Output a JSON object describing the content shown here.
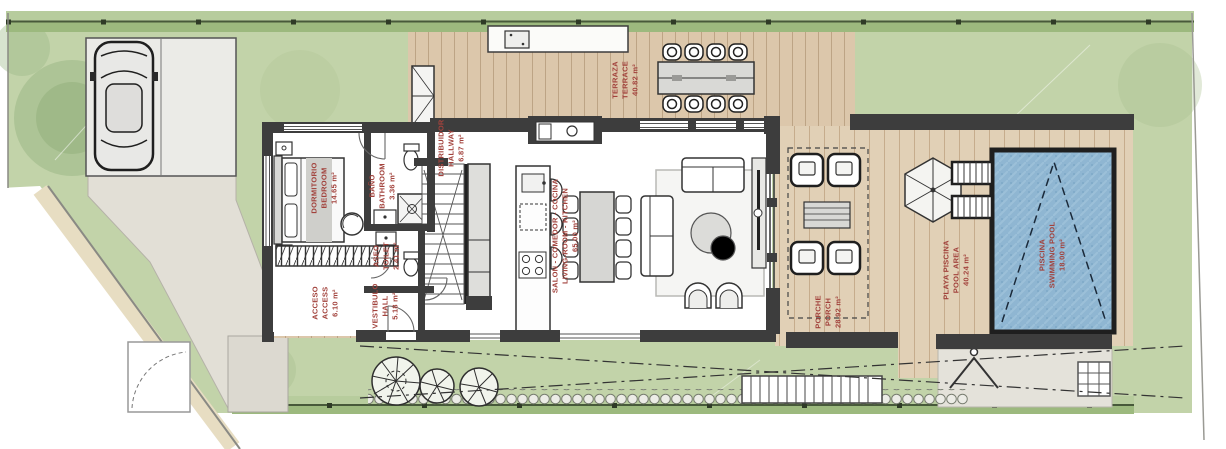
{
  "plan": {
    "rooms": {
      "terrace": {
        "name_es": "TERRAZA",
        "name_en": "TERRACE",
        "area": "40.82 m²"
      },
      "bedroom": {
        "name_es": "DORMITORIO",
        "name_en": "BEDROOM",
        "area": "14.65 m²"
      },
      "bathroom": {
        "name_es": "BAÑO",
        "name_en": "BATHROOM",
        "area": "3.36 m²"
      },
      "toilet": {
        "name_es": "ASEO",
        "name_en": "TOILET",
        "area": "2.41 m²"
      },
      "access": {
        "name_es": "ACCESO",
        "name_en": "ACCESS",
        "area": "6.10 m²"
      },
      "hall": {
        "name_es": "VESTIBULO",
        "name_en": "HALL",
        "area": "5.18 m²"
      },
      "hallway": {
        "name_es": "DISTRIBUIDOR",
        "name_en": "HALLWAY",
        "area": "6.87 m²"
      },
      "living": {
        "name_es": "SALON - COMEDOR - COCINA",
        "name_en": "LIVING-ROOM - KITCHEN",
        "area": "65.00 m²"
      },
      "porch": {
        "name_es": "PORCHE",
        "name_en": "PORCH",
        "area": "28.92 m²"
      },
      "pool_area": {
        "name_es": "PLAYA PISCINA",
        "name_en": "POOL AREA",
        "area": "40.24 m²"
      },
      "pool": {
        "name_es": "PISCINA",
        "name_en": "SWIMMING POOL",
        "area": "18.00 m²"
      }
    },
    "colors": {
      "label_text": "#a2423c",
      "grass": "#c2d3a9",
      "wood_deck": "#dcc7ab",
      "pool_water": "#8fb6d2",
      "wall": "#3d3d3d",
      "hedge": "#9cb97e"
    }
  }
}
